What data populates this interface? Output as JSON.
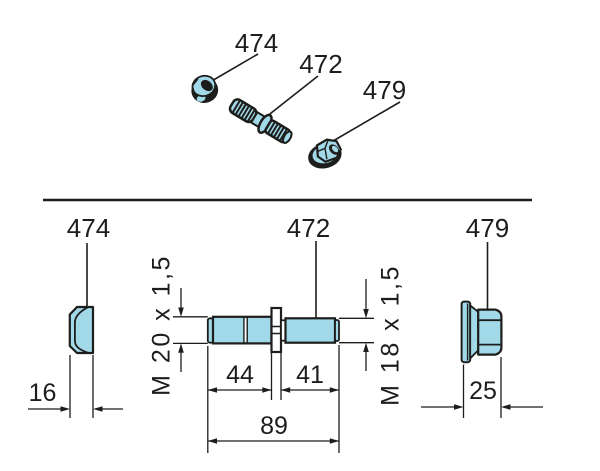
{
  "colors": {
    "part_fill": "#a2d9e8",
    "line": "#1d1d1b",
    "background": "#ffffff"
  },
  "pictorial_view": {
    "nut_label": "474",
    "stud_label": "472",
    "flange_nut_label": "479"
  },
  "dimensioned_view": {
    "nut_label": "474",
    "stud_label": "472",
    "flange_nut_label": "479",
    "nut_width": "16",
    "flange_nut_width": "25",
    "stud_left_thread": "M 20 x 1,5",
    "stud_right_thread": "M 18 x 1,5",
    "stud_left_length": "44",
    "stud_right_length": "41",
    "stud_total_length": "89"
  }
}
